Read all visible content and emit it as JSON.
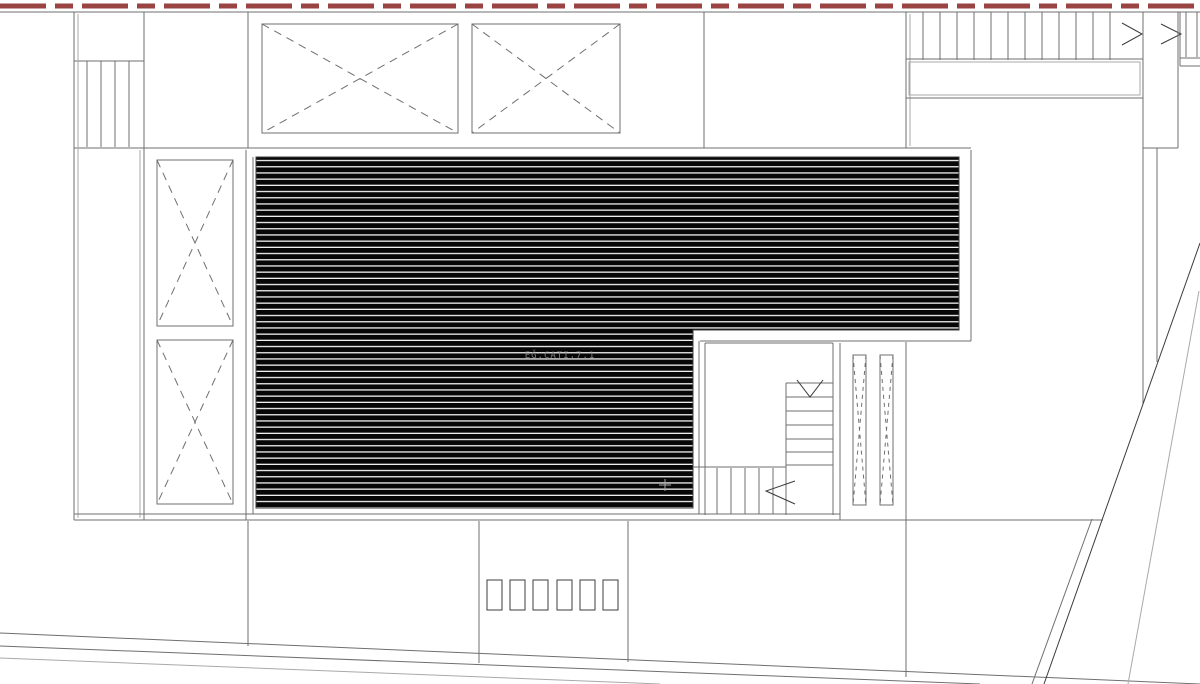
{
  "drawing": {
    "roof_label": "EĞ.ÇATI,7.1",
    "colors": {
      "line": "#6f6f6f",
      "dark": "#3c3c3c",
      "light": "#a9a9a9",
      "red": "#9a4343",
      "black": "#070707",
      "bg": "#ffffff",
      "label": "#919191"
    }
  }
}
